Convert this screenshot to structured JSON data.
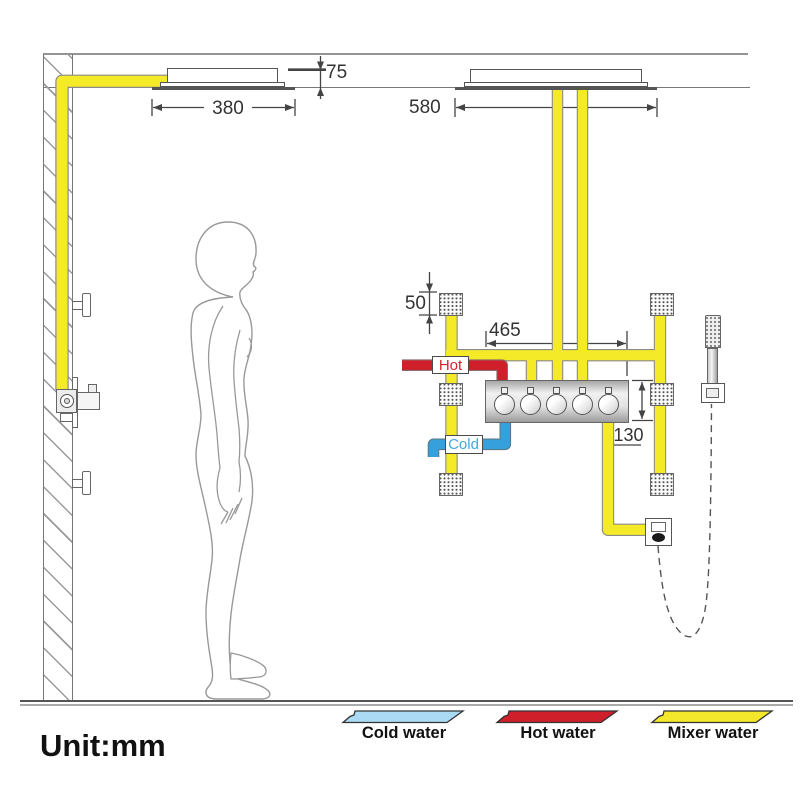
{
  "unit_label": "Unit:mm",
  "dimensions": {
    "head_drop": "75",
    "small_head_width": "380",
    "large_head_width": "580",
    "body_jet_size": "50",
    "valve_width": "465",
    "valve_height": "130"
  },
  "pipe_labels": {
    "hot": "Hot",
    "cold": "Cold"
  },
  "legend": {
    "items": [
      {
        "label": "Cold water",
        "color": "#ABDBF4"
      },
      {
        "label": "Hot water",
        "color": "#CE1F2B"
      },
      {
        "label": "Mixer water",
        "color": "#F3E82B"
      }
    ]
  },
  "colors": {
    "mixer_pipe": "#F5EA28",
    "hot_pipe": "#CE1F2B",
    "cold_pipe": "#35A0DB",
    "hot_text": "#D42330",
    "cold_text": "#3FA9E0",
    "drawing_line": "#555555"
  }
}
